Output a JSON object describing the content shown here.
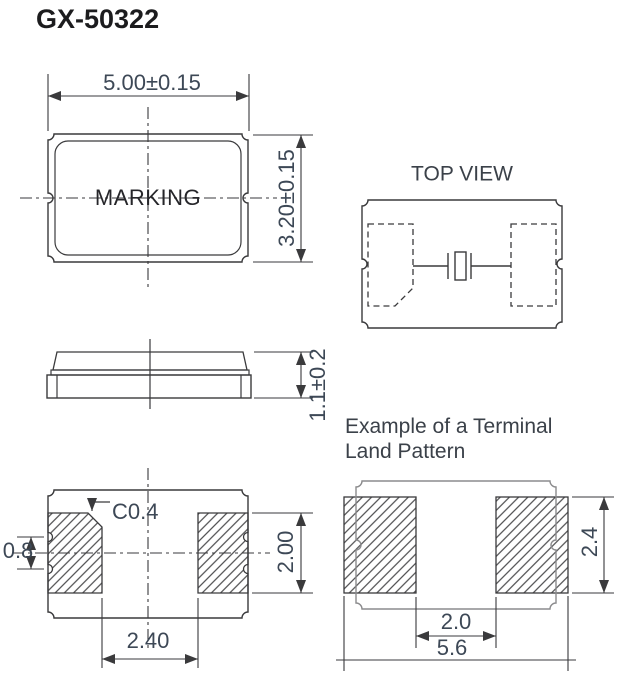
{
  "title": "GX-50322",
  "front_view": {
    "marking": "MARKING",
    "dim_width": "5.00±0.15",
    "dim_height": "3.20±0.15"
  },
  "top_view": {
    "label": "TOP VIEW"
  },
  "side_view": {
    "dim_thickness": "1.1±0.2"
  },
  "bottom_view": {
    "chamfer": "C0.4",
    "dim_castellation": "0.8",
    "dim_pad_height": "2.00",
    "dim_pad_gap": "2.40"
  },
  "land_pattern": {
    "title_line1": "Example of a Terminal",
    "title_line2": "Land Pattern",
    "dim_gap": "2.0",
    "dim_overall_width": "5.6",
    "dim_pad_height": "2.4"
  },
  "colors": {
    "line": "#3a3a3c",
    "dim_text": "#3d4856",
    "label_text": "#3b4149",
    "title_text": "#1c1c1e",
    "land_outline": "#8b8b8d"
  }
}
